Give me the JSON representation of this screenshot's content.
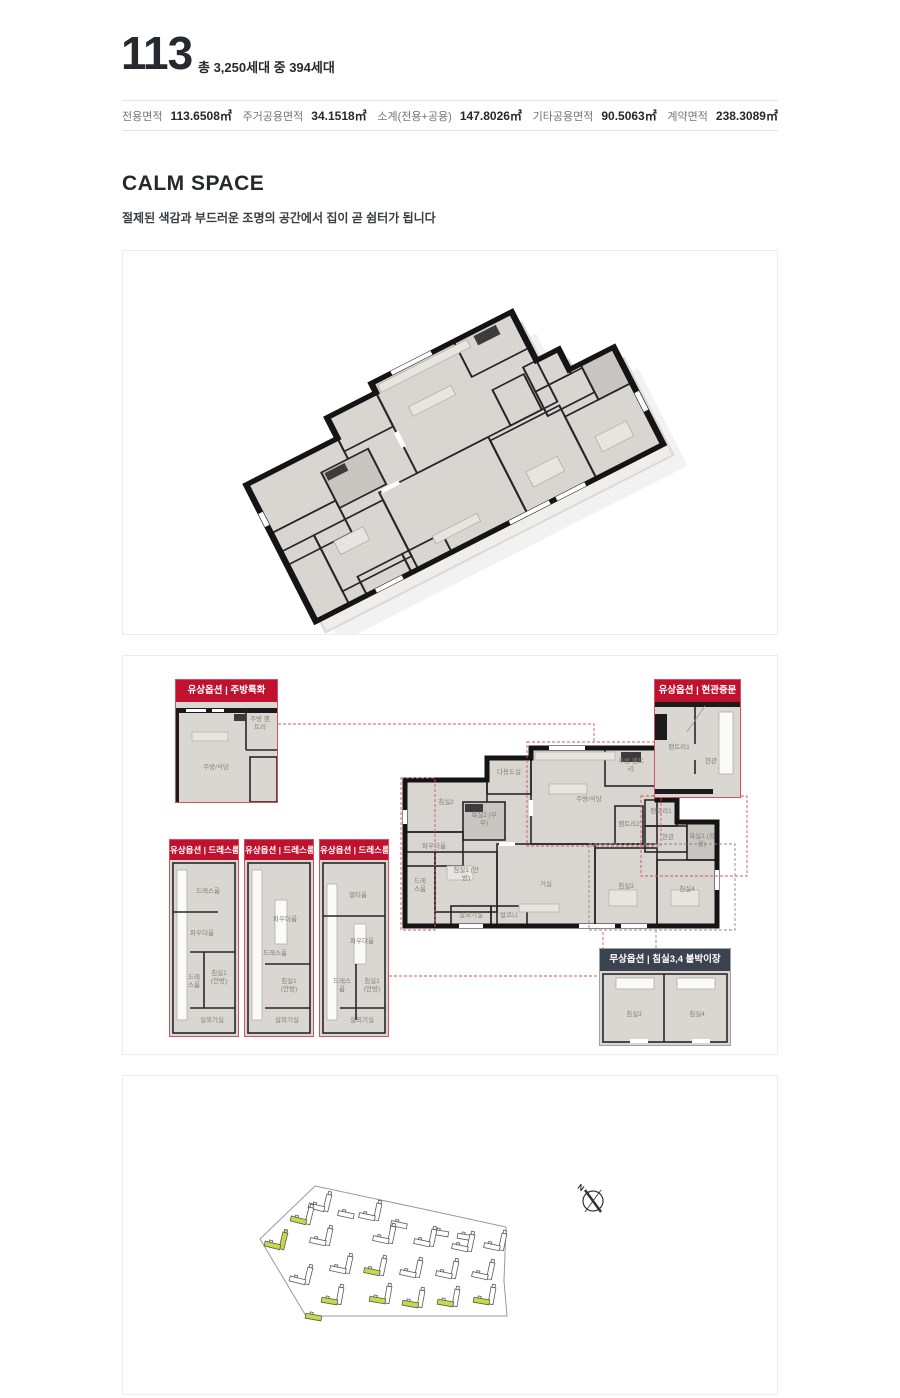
{
  "header": {
    "unit_type": "113",
    "household_info": "총 3,250세대 중 394세대"
  },
  "specs": {
    "items": [
      {
        "label": "전용면적",
        "value": "113.6508㎡"
      },
      {
        "label": "주거공용면적",
        "value": "34.1518㎡"
      },
      {
        "label": "소계(전용+공용)",
        "value": "147.8026㎡"
      },
      {
        "label": "기타공용면적",
        "value": "90.5063㎡"
      },
      {
        "label": "계약면적",
        "value": "238.3089㎡"
      }
    ]
  },
  "section": {
    "title": "CALM SPACE",
    "description": "절제된 색감과 부드러운 조명의 공간에서 집이 곧 쉼터가 됩니다"
  },
  "plan2d": {
    "callouts": {
      "kitchen": {
        "header": "유상옵션 | 주방특화",
        "rooms": {
          "r1": "주방/식당",
          "r2": "주방 팬트리"
        }
      },
      "entrance": {
        "header": "유상옵션 | 현관중문",
        "rooms": {
          "r1": "팬트리1",
          "r2": "현관"
        }
      },
      "dress3": {
        "header": "유상옵션 | 드레스룸특화3",
        "rooms": {
          "r1": "드레스룸",
          "r2": "파우더룸",
          "r3": "드레스룸",
          "r4": "침실1 (안방)",
          "r5": "실외기실"
        }
      },
      "dress2": {
        "header": "유상옵션 | 드레스룸특화2",
        "rooms": {
          "r1": "파우더룸",
          "r2": "드레스룸",
          "r3": "침실1 (안방)",
          "r4": "실외기실"
        }
      },
      "dress1": {
        "header": "유상옵션 | 드레스룸특화1",
        "rooms": {
          "r1": "멀티룸",
          "r2": "파우더룸",
          "r3": "드레스룸",
          "r4": "침실1 (안방)",
          "r5": "실외기실"
        }
      },
      "closet": {
        "header": "무상옵션 | 침실3,4 붙박이장",
        "rooms": {
          "r1": "침실3",
          "r2": "침실4"
        }
      }
    },
    "main_rooms": {
      "bedroom2": "침실2",
      "utility": "다용도실",
      "bath2": "욕실2 (부부)",
      "powder": "파우더룸",
      "dress": "드레스룸",
      "bedroom1": "침실1 (안방)",
      "outdoor_unit": "실외기실",
      "balcony": "발코니",
      "kitchen": "주방/식당",
      "kitchen_pantry": "주방 팬트리",
      "pantry2": "팬트리2",
      "pantry1": "팬트리1",
      "entrance": "현관",
      "bath1": "욕실1 (공용)",
      "living": "거실",
      "bedroom3": "침실3",
      "bedroom4": "침실4"
    }
  },
  "site_plan": {
    "compass_label": "N",
    "buildings": [
      {
        "x": 204,
        "y": 118,
        "r": 14,
        "t": 1,
        "s": 1,
        "hl": ""
      },
      {
        "x": 233,
        "y": 125,
        "r": 12,
        "t": 0,
        "s": 1,
        "hl": ""
      },
      {
        "x": 254,
        "y": 127,
        "r": 12,
        "t": 1,
        "s": 1,
        "hl": ""
      },
      {
        "x": 286,
        "y": 135,
        "r": 12,
        "t": 0,
        "s": 1,
        "hl": ""
      },
      {
        "x": 327,
        "y": 143,
        "r": 10,
        "t": 0,
        "s": 1,
        "hl": ""
      },
      {
        "x": 352,
        "y": 147,
        "r": 10,
        "t": 0,
        "s": 1,
        "hl": ""
      },
      {
        "x": 186,
        "y": 131,
        "r": 14,
        "t": 1,
        "s": 1,
        "hl": "s"
      },
      {
        "x": 160,
        "y": 156,
        "r": 14,
        "t": 1,
        "s": 1,
        "hl": "ts"
      },
      {
        "x": 205,
        "y": 152,
        "r": 12,
        "t": 1,
        "s": 1,
        "hl": ""
      },
      {
        "x": 268,
        "y": 150,
        "r": 12,
        "t": 1,
        "s": 1,
        "hl": ""
      },
      {
        "x": 309,
        "y": 153,
        "r": 12,
        "t": 1,
        "s": 1,
        "hl": ""
      },
      {
        "x": 347,
        "y": 158,
        "r": 12,
        "t": 1,
        "s": 1,
        "hl": ""
      },
      {
        "x": 379,
        "y": 157,
        "r": 12,
        "t": 1,
        "s": 1,
        "hl": ""
      },
      {
        "x": 185,
        "y": 191,
        "r": 14,
        "t": 1,
        "s": 1,
        "hl": ""
      },
      {
        "x": 225,
        "y": 180,
        "r": 12,
        "t": 1,
        "s": 1,
        "hl": ""
      },
      {
        "x": 259,
        "y": 182,
        "r": 12,
        "t": 1,
        "s": 1,
        "hl": "s"
      },
      {
        "x": 295,
        "y": 184,
        "r": 12,
        "t": 1,
        "s": 1,
        "hl": ""
      },
      {
        "x": 331,
        "y": 185,
        "r": 12,
        "t": 1,
        "s": 1,
        "hl": ""
      },
      {
        "x": 367,
        "y": 186,
        "r": 12,
        "t": 1,
        "s": 1,
        "hl": ""
      },
      {
        "x": 216,
        "y": 211,
        "r": 10,
        "t": 1,
        "s": 1,
        "hl": "s"
      },
      {
        "x": 200,
        "y": 227,
        "r": 10,
        "t": 0,
        "s": 1,
        "hl": "s"
      },
      {
        "x": 264,
        "y": 210,
        "r": 10,
        "t": 1,
        "s": 1,
        "hl": "s"
      },
      {
        "x": 297,
        "y": 214,
        "r": 10,
        "t": 1,
        "s": 1,
        "hl": "s"
      },
      {
        "x": 332,
        "y": 213,
        "r": 10,
        "t": 1,
        "s": 1,
        "hl": "s"
      },
      {
        "x": 368,
        "y": 211,
        "r": 10,
        "t": 1,
        "s": 1,
        "hl": "s"
      }
    ]
  },
  "colors": {
    "accent_red": "#c0122f",
    "option_navy": "#3b4250",
    "wall": "#1b1b1b",
    "floor": "#d9d6d1",
    "site_highlight": "#c8d847"
  }
}
